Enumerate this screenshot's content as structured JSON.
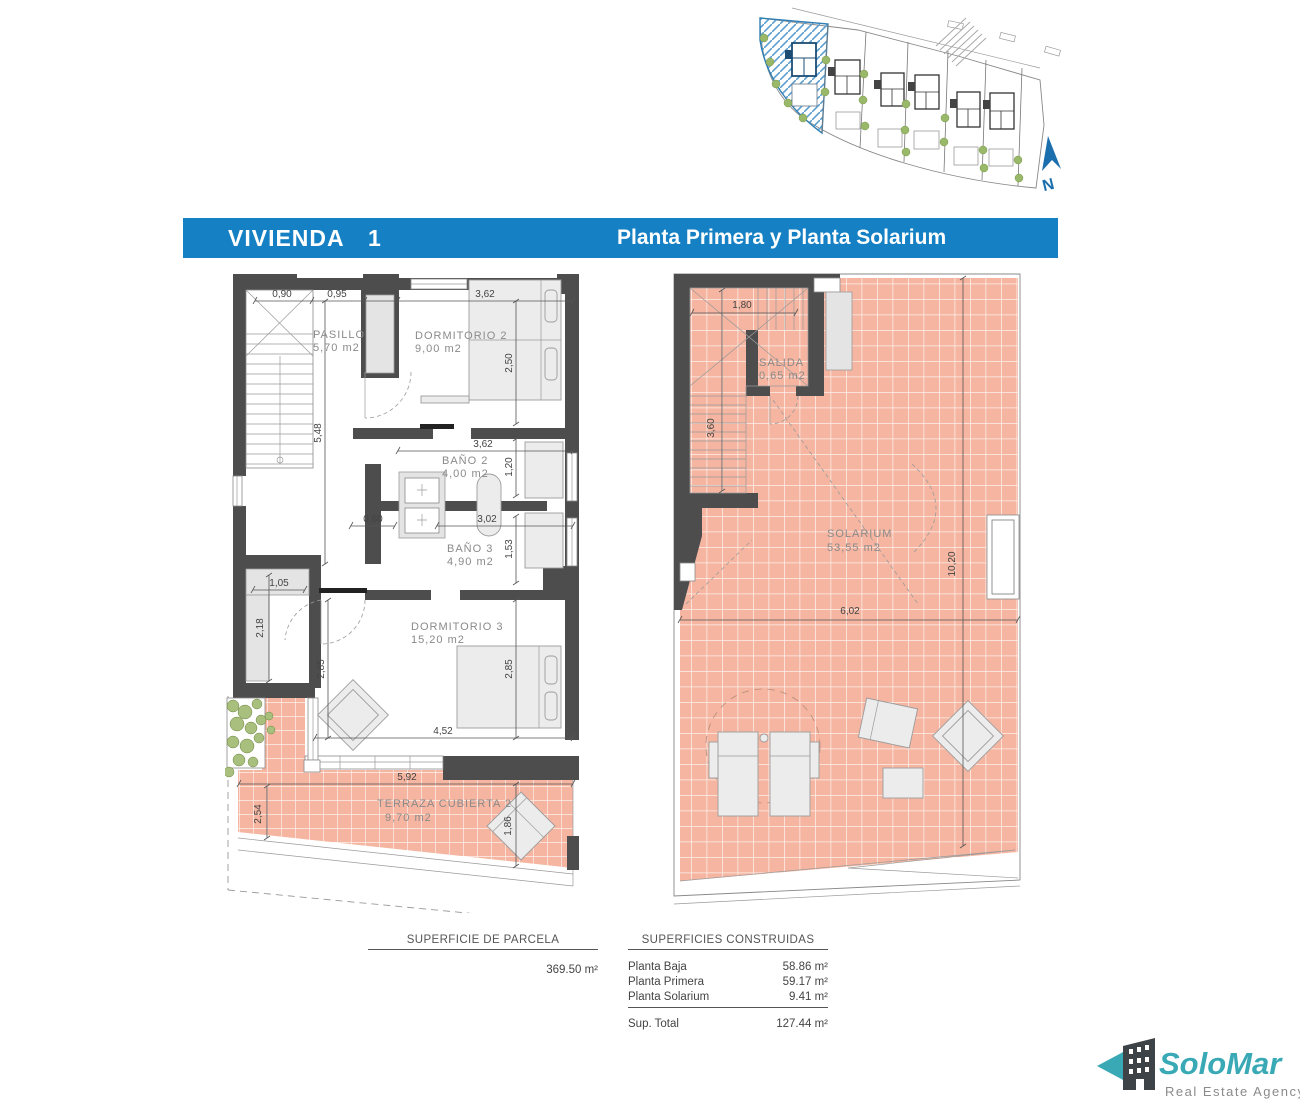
{
  "header": {
    "title": "VIVIENDA",
    "unit": "1",
    "subtitle": "Planta Primera y Planta Solarium"
  },
  "site": {
    "north": "N"
  },
  "plan_first": {
    "rooms": [
      {
        "label": "PASILLO",
        "area": "5,70 m2"
      },
      {
        "label": "DORMITORIO 2",
        "area": "9,00 m2"
      },
      {
        "label": "BAÑO 2",
        "area": "4,00 m2"
      },
      {
        "label": "BAÑO 3",
        "area": "4,90 m2"
      },
      {
        "label": "DORMITORIO 3",
        "area": "15,20 m2"
      },
      {
        "label": "TERRAZA CUBIERTA 2",
        "area": "9,70 m2"
      }
    ],
    "dims": [
      "0,90",
      "0,95",
      "3,62",
      "2,50",
      "5,48",
      "3,62",
      "1,20",
      "0,60",
      "3,02",
      "1,53",
      "1,05",
      "2,18",
      "2,85",
      "2,85",
      "4,52",
      "5,92",
      "2,54",
      "1,86"
    ]
  },
  "plan_solarium": {
    "rooms": [
      {
        "label": "SALIDA",
        "area": "0,65 m2"
      },
      {
        "label": "SOLARIUM",
        "area": "53,55 m2"
      }
    ],
    "dims": [
      "1,80",
      "3,60",
      "10,20",
      "6,02"
    ]
  },
  "summary": {
    "parcela": {
      "heading": "SUPERFICIE DE PARCELA",
      "value": "369.50 m²"
    },
    "construidas": {
      "heading": "SUPERFICIES CONSTRUIDAS",
      "rows": [
        {
          "label": "Planta Baja",
          "value": "58.86 m²"
        },
        {
          "label": "Planta Primera",
          "value": "59.17 m²"
        },
        {
          "label": "Planta Solarium",
          "value": "9.41 m²"
        }
      ],
      "total": {
        "label": "Sup. Total",
        "value": "127.44 m²"
      }
    }
  },
  "logo": {
    "name": "SoloMar",
    "tagline": "Real Estate Agency"
  },
  "colors": {
    "accent_blue": "#1581c4",
    "tile_pink": "#f5b5a0",
    "wall_dark": "#4d4d4d",
    "logo_teal": "#39a9b5",
    "site_blue": "#2f7fb5"
  }
}
